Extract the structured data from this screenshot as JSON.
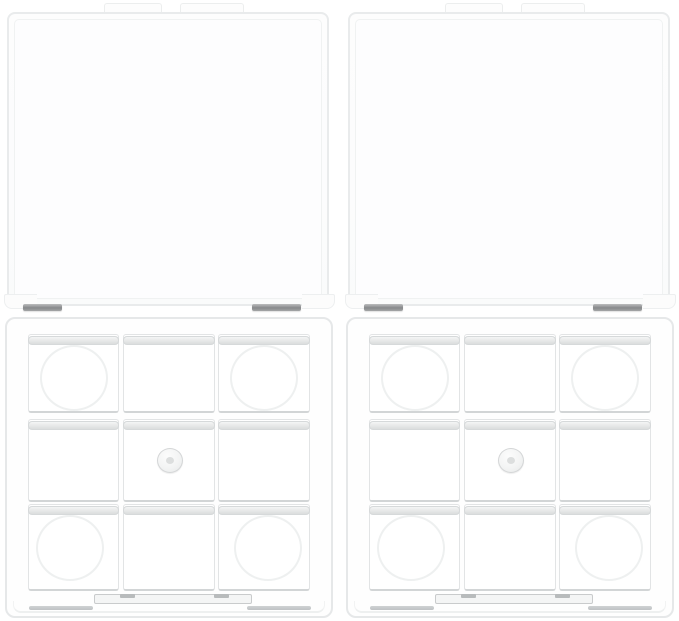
{
  "meta": {
    "description": "Two identical empty clear transparent plastic eyeshadow palette cases with open hinged lids, each base holding a 3 by 3 grid of square pan wells, on a plain white background"
  },
  "product": {
    "item_count": 2,
    "wells_per_palette": 9,
    "grid": "3x3",
    "appearance": "clear transparent plastic, empty"
  },
  "palettes": [
    {
      "position": "left"
    },
    {
      "position": "right"
    }
  ],
  "features": [
    "open hinged clear lid with two top tabs",
    "two gray metal hinge pins",
    "textured hinge bar",
    "round pan recess in each corner well",
    "small round magnet button in center well",
    "front latch bar with two notches",
    "gray trim lines along bottom edge"
  ],
  "colors": {
    "background": "#ffffff",
    "lid_fill": "#fdfdfd",
    "lid_border": "#e9ebec",
    "base_border": "#e6e8e9",
    "well_border": "#e2e4e5",
    "well_bottom_edge": "#d2d5d6",
    "lip_light": "#f4f5f5",
    "lip_dark": "#dbdddd",
    "hinge_pin": "#87898b",
    "hinge_bar": "#9ca1a3",
    "latch_border": "#c9cbcc",
    "edge_line": "#c5c8ca",
    "recess_ring": "#eef0f0",
    "magnet_border": "#d4d6d7"
  }
}
